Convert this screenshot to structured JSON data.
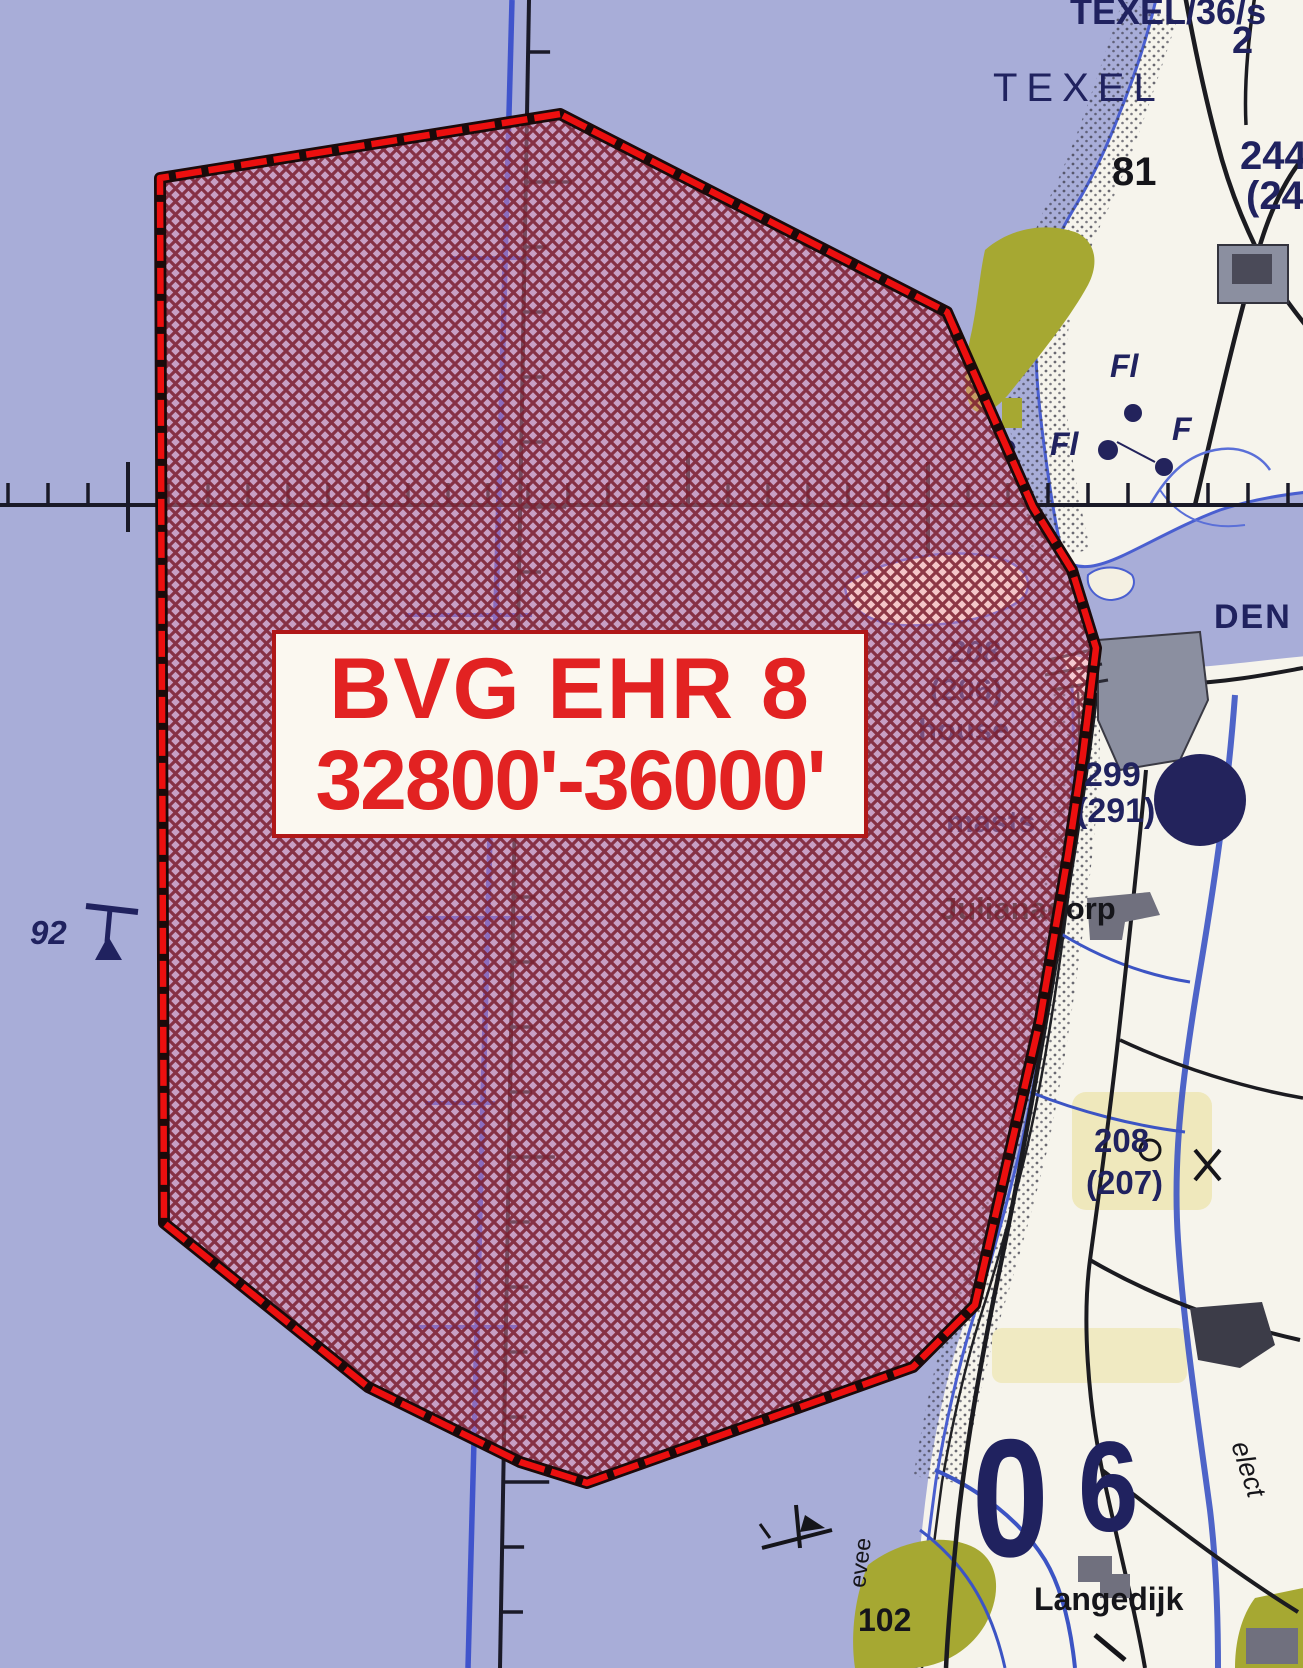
{
  "map_title": "Military aeronautical chart extract - Den Helder / Texel area",
  "info_box": {
    "line1": "BVG EHR 8",
    "line2": "32800'-36000'"
  },
  "palette": {
    "sea": "#a8add8",
    "land": "#f6f4ec",
    "navy": "#20225f",
    "black": "#15151a",
    "red": "#e22222",
    "border_red": "#ec0f0f",
    "hatch_line": "#7b1d2d",
    "hatch_tint": "#f28ca8",
    "olive": "#a6a832",
    "pale_yellow": "#efe8bc",
    "builtup_gray": "#8b8fa0",
    "water_blue": "#3c54c4"
  },
  "map_labels": [
    {
      "id": "texel-36s",
      "text": "TEXEL/36/s",
      "x": 1070,
      "y": -6,
      "size": 36,
      "color": "navy",
      "bold": true
    },
    {
      "id": "texel",
      "text": "TEXEL",
      "x": 993,
      "y": 68,
      "size": 40,
      "color": "navy",
      "bold": false,
      "ls": 9
    },
    {
      "id": "num-2",
      "text": "2",
      "x": 1232,
      "y": 22,
      "size": 38,
      "color": "navy",
      "bold": true
    },
    {
      "id": "num-81",
      "text": "81",
      "x": 1112,
      "y": 152,
      "size": 40,
      "color": "black",
      "bold": true
    },
    {
      "id": "num-244",
      "text": "244",
      "x": 1240,
      "y": 136,
      "size": 40,
      "color": "navy",
      "bold": true
    },
    {
      "id": "num-24p",
      "text": "(24",
      "x": 1246,
      "y": 176,
      "size": 40,
      "color": "navy",
      "bold": true
    },
    {
      "id": "fl-1",
      "text": "Fl",
      "x": 1110,
      "y": 350,
      "size": 32,
      "color": "navy",
      "bold": true,
      "italic": true
    },
    {
      "id": "fl-2",
      "text": "Fl",
      "x": 1050,
      "y": 428,
      "size": 32,
      "color": "navy",
      "bold": true,
      "italic": true
    },
    {
      "id": "f-1",
      "text": "F",
      "x": 1172,
      "y": 413,
      "size": 32,
      "color": "navy",
      "bold": true,
      "italic": true
    },
    {
      "id": "den",
      "text": "DEN",
      "x": 1214,
      "y": 600,
      "size": 34,
      "color": "navy",
      "bold": true,
      "ls": 2
    },
    {
      "id": "num-208a",
      "text": "208",
      "x": 948,
      "y": 636,
      "size": 31,
      "color": "navy",
      "bold": true,
      "italic": true
    },
    {
      "id": "num-206",
      "text": "(206)",
      "x": 930,
      "y": 674,
      "size": 31,
      "color": "navy",
      "bold": true
    },
    {
      "id": "house",
      "text": "house",
      "x": 918,
      "y": 714,
      "size": 31,
      "color": "navy",
      "bold": true
    },
    {
      "id": "num-299",
      "text": "299",
      "x": 1084,
      "y": 758,
      "size": 34,
      "color": "navy",
      "bold": true
    },
    {
      "id": "num-291",
      "text": "(291)",
      "x": 1076,
      "y": 794,
      "size": 34,
      "color": "navy",
      "bold": true
    },
    {
      "id": "masts",
      "text": "masts",
      "x": 946,
      "y": 806,
      "size": 31,
      "color": "navy",
      "bold": true
    },
    {
      "id": "julianadorp",
      "text": "Julianadorp",
      "x": 940,
      "y": 893,
      "size": 31,
      "color": "black",
      "bold": true
    },
    {
      "id": "num-208b",
      "text": "208",
      "x": 1094,
      "y": 1124,
      "size": 33,
      "color": "navy",
      "bold": true
    },
    {
      "id": "num-207",
      "text": "(207)",
      "x": 1086,
      "y": 1166,
      "size": 33,
      "color": "navy",
      "bold": true
    },
    {
      "id": "num-0",
      "text": "0",
      "x": 972,
      "y": 1414,
      "size": 168,
      "color": "navy",
      "bold": true,
      "scaleX": 0.82
    },
    {
      "id": "num-6",
      "text": "6",
      "x": 1078,
      "y": 1424,
      "size": 128,
      "color": "navy",
      "bold": true,
      "scaleX": 0.85
    },
    {
      "id": "langedijk",
      "text": "Langedijk",
      "x": 1034,
      "y": 1583,
      "size": 32,
      "color": "black",
      "bold": true
    },
    {
      "id": "num-102",
      "text": "102",
      "x": 858,
      "y": 1604,
      "size": 32,
      "color": "black",
      "bold": true
    },
    {
      "id": "elect",
      "text": "elect",
      "x": 1252,
      "y": 1438,
      "size": 27,
      "color": "black",
      "bold": false,
      "italic": true,
      "rot": 72
    },
    {
      "id": "evee",
      "text": "evee",
      "x": 846,
      "y": 1586,
      "size": 23,
      "color": "black",
      "bold": false,
      "rot": -83
    },
    {
      "id": "num-92",
      "text": "92",
      "x": 30,
      "y": 916,
      "size": 33,
      "color": "navy",
      "bold": true,
      "italic": true
    }
  ]
}
